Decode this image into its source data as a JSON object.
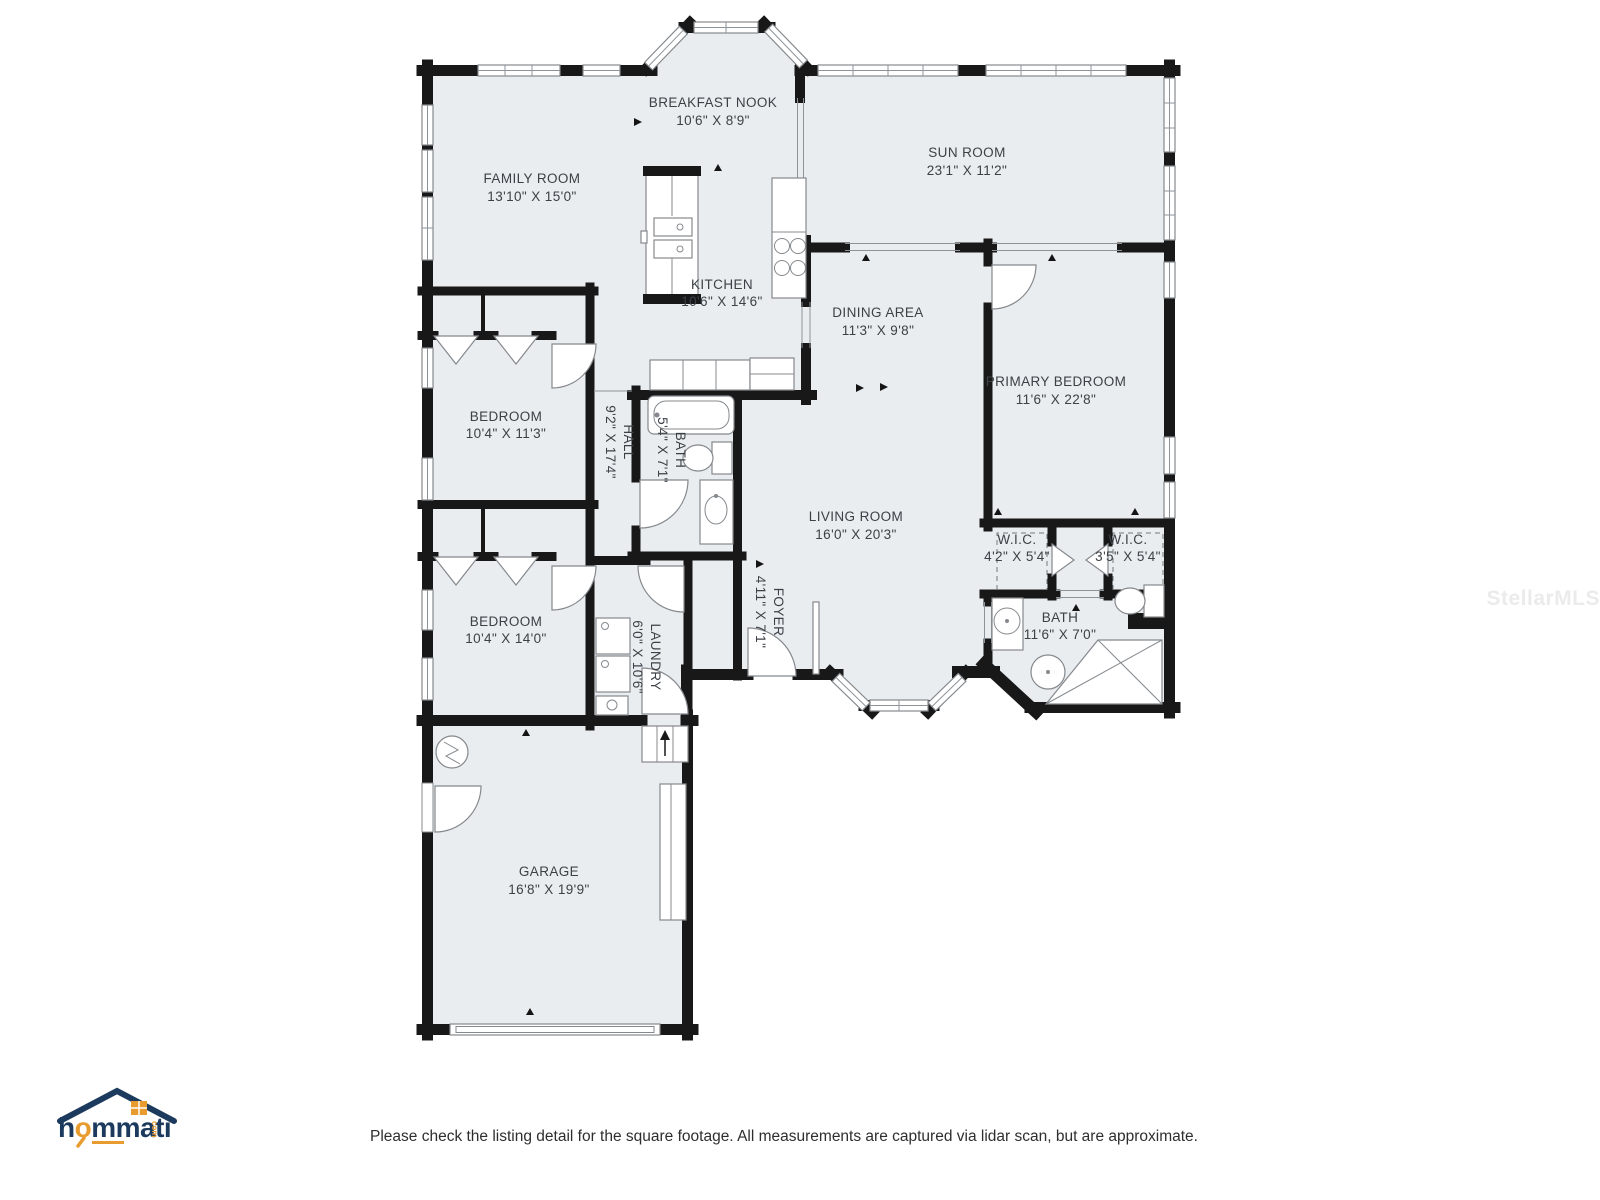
{
  "meta": {
    "watermark": "StellarMLS",
    "disclaimer": "Please check the listing detail for the square footage. All measurements are captured via lidar scan, but are approximate."
  },
  "logo": {
    "h": "h",
    "o": "o",
    "mmati": "mmati",
    "tld": "com"
  },
  "colors": {
    "floor": "#e9edf0",
    "wall": "#181818",
    "label": "#3c4147",
    "brand_navy": "#1b3a5e",
    "brand_orange": "#e89b2e",
    "watermark": "#ebebeb"
  },
  "rooms": [
    {
      "name": "FAMILY ROOM",
      "dims": "13'10\" X 15'0\""
    },
    {
      "name": "BREAKFAST NOOK",
      "dims": "10'6\" X 8'9\""
    },
    {
      "name": "SUN ROOM",
      "dims": "23'1\" X 11'2\""
    },
    {
      "name": "KITCHEN",
      "dims": "10'6\" X 14'6\""
    },
    {
      "name": "DINING AREA",
      "dims": "11'3\" X 9'8\""
    },
    {
      "name": "PRIMARY BEDROOM",
      "dims": "11'6\" X 22'8\""
    },
    {
      "name": "BEDROOM",
      "dims": "10'4\" X 11'3\""
    },
    {
      "name": "HALL",
      "dims": "9'2\" X 17'4\""
    },
    {
      "name": "BATH",
      "dims": "5'4\" X 7'1\""
    },
    {
      "name": "LIVING ROOM",
      "dims": "16'0\" X 20'3\""
    },
    {
      "name": "W.I.C.",
      "dims": "4'2\" X 5'4\""
    },
    {
      "name": "W.I.C.",
      "dims": "3'5\" X 5'4\""
    },
    {
      "name": "BATH",
      "dims": "11'6\" X 7'0\""
    },
    {
      "name": "FOYER",
      "dims": "4'11\" X 7'1\""
    },
    {
      "name": "BEDROOM",
      "dims": "10'4\" X 14'0\""
    },
    {
      "name": "LAUNDRY",
      "dims": "6'0\" X 10'6\""
    },
    {
      "name": "GARAGE",
      "dims": "16'8\" X 19'9\""
    }
  ]
}
